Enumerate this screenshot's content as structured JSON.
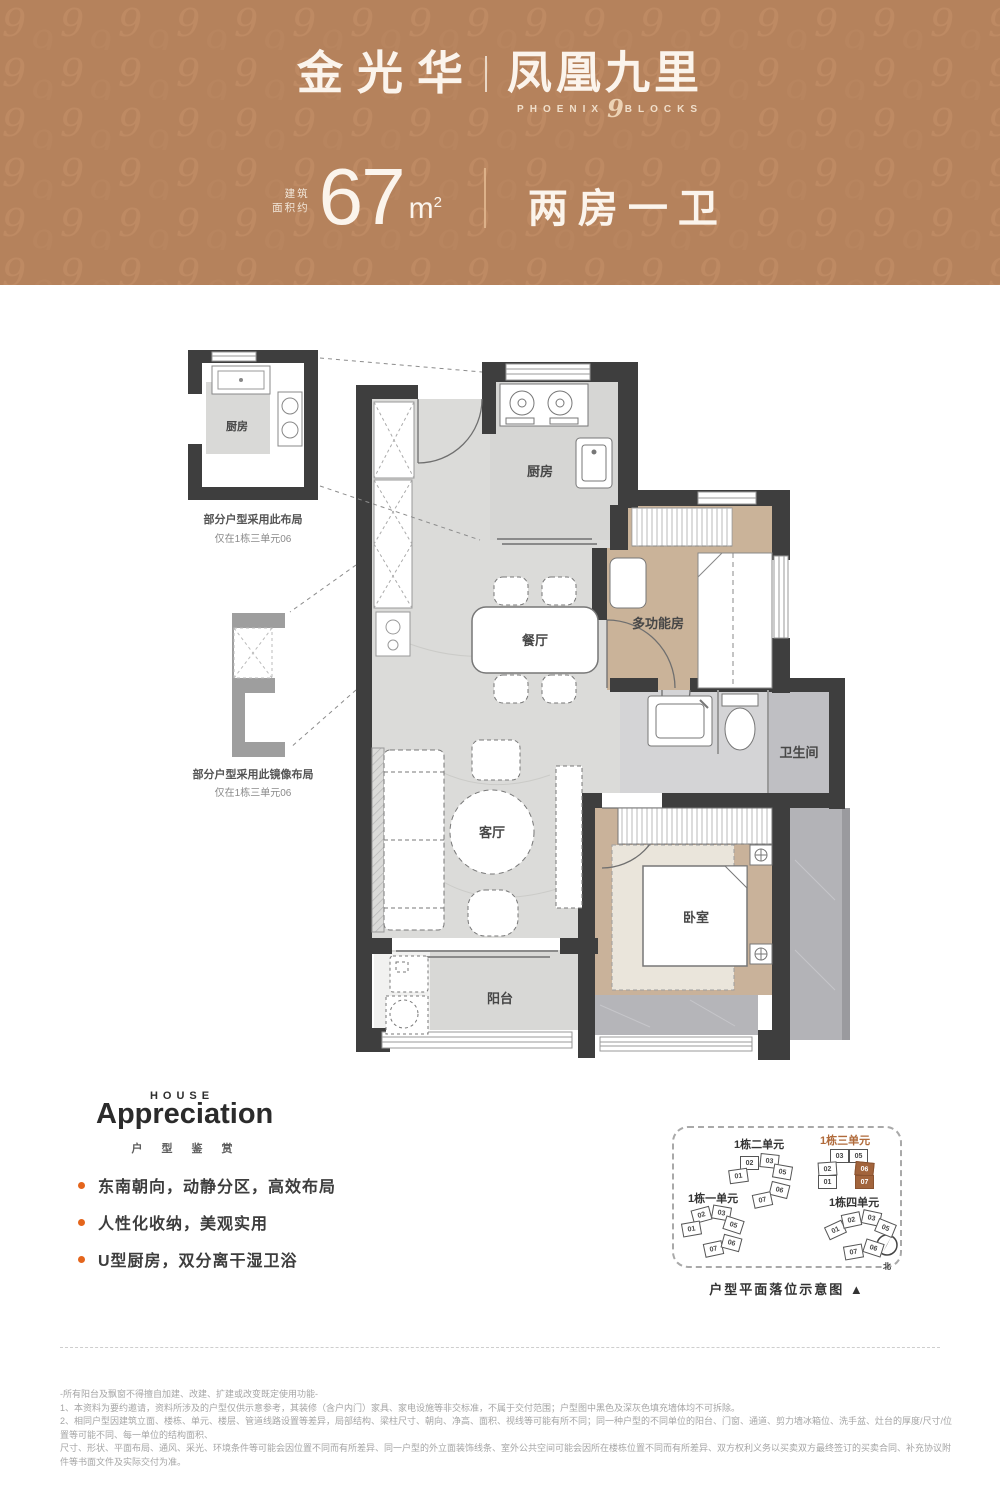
{
  "header": {
    "brand_left": "金光华",
    "brand_right": "凤凰九里",
    "sub_left": "PHOENIX",
    "sub_num": "9",
    "sub_right": "BLOCKS",
    "area_prefix_1": "建筑",
    "area_prefix_2": "面积约",
    "area_value": "67",
    "area_unit": "m",
    "area_unit_sup": "2",
    "layout_type": "两房一卫",
    "banner_color": "#b5825c"
  },
  "floorplan": {
    "rooms": {
      "kitchen": "厨房",
      "dining": "餐厅",
      "multi": "多功能房",
      "bath": "卫生间",
      "living": "客厅",
      "bedroom": "卧室",
      "balcony": "阳台",
      "inset_kitchen": "厨房"
    },
    "inset_top_note1": "部分户型采用此布局",
    "inset_top_note2": "仅在1栋三单元06",
    "inset_bottom_note1": "部分户型采用此镜像布局",
    "inset_bottom_note2": "仅在1栋三单元06"
  },
  "appreciation": {
    "eyebrow": "HOUSE",
    "title": "Appreciation",
    "subtitle": "户型鉴赏",
    "bullets": [
      "东南朝向，动静分区，高效布局",
      "人性化收纳，美观实用",
      "U型厨房，双分离干湿卫浴"
    ],
    "bullet_color": "#e4651c"
  },
  "keyplan": {
    "caption": "户型平面落位示意图 ▲",
    "compass_top": "南",
    "compass_bottom": "北",
    "accent_color": "#b06a3a",
    "clusters": [
      {
        "label": "1栋二单元",
        "accent": false,
        "units": [
          "02",
          "03",
          "01",
          "05",
          "06",
          "07"
        ],
        "highlighted": []
      },
      {
        "label": "1栋三单元",
        "accent": true,
        "units": [
          "03",
          "05",
          "02",
          "01",
          "06",
          "07"
        ],
        "highlighted": [
          "06",
          "07"
        ]
      },
      {
        "label": "1栋一单元",
        "accent": false,
        "units": [
          "02",
          "03",
          "01",
          "05",
          "07",
          "06"
        ],
        "highlighted": []
      },
      {
        "label": "1栋四单元",
        "accent": false,
        "units": [
          "01",
          "02",
          "03",
          "05",
          "07",
          "06"
        ],
        "highlighted": []
      }
    ]
  },
  "disclaimer": {
    "lines": [
      "-所有阳台及飘窗不得擅自加建、改建、扩建或改变既定使用功能-",
      "1、本资料为要约邀请，资料所涉及的户型仅供示意参考，其装修（含户内门）家具、家电设施等非交标准，不属于交付范围；户型图中黑色及深灰色填充墙体均不可拆除。",
      "2、相同户型因建筑立面、楼栋、单元、楼层、管道线路设置等差异，局部结构、梁柱尺寸、朝向、净高、面积、视线等可能有所不同；同一种户型的不同单位的阳台、门窗、通道、剪力墙冰箱位、洗手盆、灶台的厚度/尺寸/位置等可能不同、每一单位的结构面积、",
      "尺寸、形状、平面布局、通风、采光、环境条件等可能会因位置不同而有所差异、同一户型的外立面装饰线条、室外公共空间可能会因所在楼栋位置不同而有所差异、双方权利义务以买卖双方最终签订的买卖合同、补充协议附件等书面文件及实际交付为准。"
    ]
  }
}
